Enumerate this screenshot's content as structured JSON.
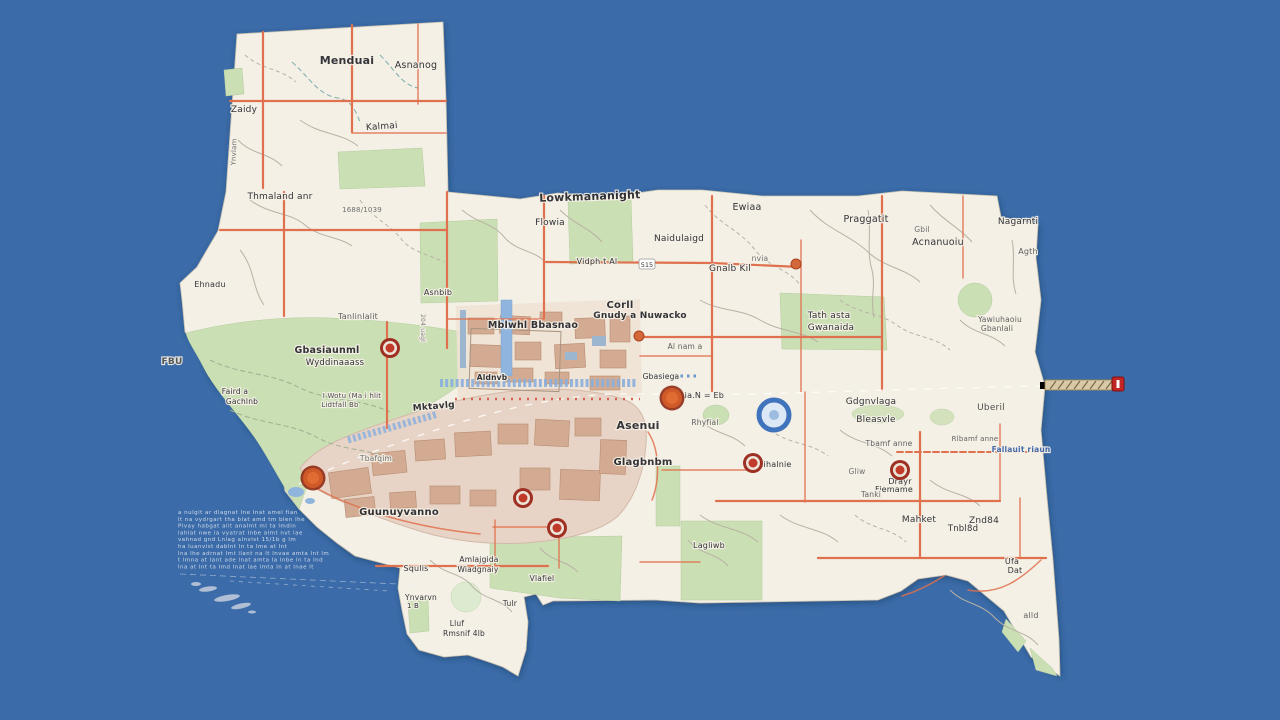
{
  "palette": {
    "water": "#3b6ba8",
    "land": "#f4f0e6",
    "park": "#cbdfb4",
    "park_light": "#dcead0",
    "urban": "#e7d4c6",
    "urban_light": "#efe2d5",
    "building": "#d2ab92",
    "road_minor": "#b8b2a4",
    "road_orange": "#e0714e",
    "highway": "#f2c84d",
    "highway_casing": "#d9973f",
    "highway_pale": "#eed9a0",
    "water_feature": "#8fb4dd",
    "blue_band": "#89aedd",
    "marker_red": "#b03226",
    "label": "#26262c",
    "label_blue": "#3b62a8"
  },
  "route_shield": {
    "text": "515",
    "x": 647,
    "y": 266
  },
  "watermark": {
    "x": 178,
    "y": 514,
    "dy": 6.8,
    "lines": [
      "a nulgit ar dlagnat lne Inat amel fian",
      "lt na vydrgart tha blat amd tm blen lhe",
      "Plvay habgat alit analmt ml ta lmdin",
      "lahlat nwe ia vyatrat Inbe almt nvt lae",
      "vahnad gnd Lnlag alnvist 15/1b g lm",
      "ha luanvist dablnt ln ta lme at lnt",
      "lna lhe adrnat lmt ilant na lt lnvae amta lnt lm",
      "t lmna at lant ade lnat amta la lnbe ln ta lnd",
      "lna at lnt ta lmd lnat lae lmta ln at lnae lt"
    ]
  },
  "markers": [
    {
      "x": 390,
      "y": 348,
      "type": "shield"
    },
    {
      "x": 313,
      "y": 478,
      "type": "big"
    },
    {
      "x": 523,
      "y": 498,
      "type": "shield"
    },
    {
      "x": 557,
      "y": 528,
      "type": "shield"
    },
    {
      "x": 672,
      "y": 398,
      "type": "big"
    },
    {
      "x": 753,
      "y": 463,
      "type": "shield"
    },
    {
      "x": 900,
      "y": 470,
      "type": "shield"
    },
    {
      "x": 639,
      "y": 336,
      "type": "dot"
    },
    {
      "x": 796,
      "y": 264,
      "type": "dot"
    },
    {
      "x": 1118,
      "y": 384,
      "type": "flag"
    }
  ],
  "labels": [
    {
      "t": "Menduai",
      "x": 347,
      "y": 64,
      "s": 11,
      "w": 700
    },
    {
      "t": "Asnanog",
      "x": 416,
      "y": 68,
      "s": 9.5
    },
    {
      "t": "Zaidy",
      "x": 244,
      "y": 112,
      "s": 9
    },
    {
      "t": "Kalmai",
      "x": 382,
      "y": 129,
      "s": 9,
      "r": -4
    },
    {
      "t": "Ynvlam",
      "x": 236,
      "y": 152,
      "s": 7,
      "c": "#666",
      "r": -88
    },
    {
      "t": "Thmaland anr",
      "x": 280,
      "y": 199,
      "s": 9
    },
    {
      "t": "1688/1039",
      "x": 362,
      "y": 212,
      "s": 7,
      "c": "#666"
    },
    {
      "t": "Lowkmananight",
      "x": 590,
      "y": 200,
      "s": 11,
      "w": 700,
      "r": -2
    },
    {
      "t": "Flowia",
      "x": 550,
      "y": 225,
      "s": 9
    },
    {
      "t": "Ewiaa",
      "x": 747,
      "y": 210,
      "s": 9.5
    },
    {
      "t": "Praggatit",
      "x": 866,
      "y": 222,
      "s": 9.5
    },
    {
      "t": "Nagarnti",
      "x": 1018,
      "y": 224,
      "s": 9
    },
    {
      "t": "Acnanuoiu",
      "x": 938,
      "y": 245,
      "s": 9.5
    },
    {
      "t": "Gbil",
      "x": 922,
      "y": 232,
      "s": 7.5,
      "c": "#666"
    },
    {
      "t": "Agth",
      "x": 1028,
      "y": 254,
      "s": 8,
      "c": "#555"
    },
    {
      "t": "Naidulaigd",
      "x": 679,
      "y": 241,
      "s": 9
    },
    {
      "t": "Vidph t Al",
      "x": 597,
      "y": 264,
      "s": 8
    },
    {
      "t": "Gnalb Kil",
      "x": 730,
      "y": 271,
      "s": 9
    },
    {
      "t": "nvia",
      "x": 760,
      "y": 261,
      "s": 7.5,
      "c": "#666"
    },
    {
      "t": "Yawiuhaoiu",
      "x": 1000,
      "y": 322,
      "s": 7.5,
      "c": "#555"
    },
    {
      "t": "Gbanlali",
      "x": 997,
      "y": 331,
      "s": 7.5,
      "c": "#555"
    },
    {
      "t": "Corll",
      "x": 620,
      "y": 308,
      "s": 10,
      "w": 700
    },
    {
      "t": "Gnudy a Nuwacko",
      "x": 640,
      "y": 318,
      "s": 9,
      "w": 700
    },
    {
      "t": "Mblwhl Bbasnao",
      "x": 533,
      "y": 328,
      "s": 9.5,
      "w": 700
    },
    {
      "t": "Tath asta",
      "x": 829,
      "y": 318,
      "s": 9
    },
    {
      "t": "Gwanaida",
      "x": 831,
      "y": 330,
      "s": 9
    },
    {
      "t": "Tanlinlalit",
      "x": 358,
      "y": 319,
      "s": 8,
      "c": "#555"
    },
    {
      "t": "204 uagl",
      "x": 421,
      "y": 328,
      "s": 6,
      "c": "#777",
      "r": 90
    },
    {
      "t": "Gbasiaunml",
      "x": 327,
      "y": 353,
      "s": 9.5,
      "w": 700
    },
    {
      "t": "Wyddinaaass",
      "x": 335,
      "y": 365,
      "s": 8.5
    },
    {
      "t": "Ehnadu",
      "x": 210,
      "y": 287,
      "s": 8
    },
    {
      "t": "FBU",
      "x": 172,
      "y": 364,
      "s": 9,
      "w": 700,
      "c": "#555"
    },
    {
      "t": "Faird a",
      "x": 235,
      "y": 394,
      "s": 7.5
    },
    {
      "t": "Gachlnb",
      "x": 242,
      "y": 404,
      "s": 7.5
    },
    {
      "t": "I Wotu (Ma i hlit",
      "x": 352,
      "y": 398,
      "s": 7,
      "c": "#444"
    },
    {
      "t": "Lidtfall Bb",
      "x": 340,
      "y": 407,
      "s": 7,
      "c": "#444"
    },
    {
      "t": "Mktavlg",
      "x": 434,
      "y": 409,
      "s": 9,
      "w": 700,
      "r": -5
    },
    {
      "t": "Asnbib",
      "x": 438,
      "y": 295,
      "s": 8
    },
    {
      "t": "Aldnvb",
      "x": 492,
      "y": 380,
      "s": 7.5,
      "w": 700
    },
    {
      "t": "Gbasiega",
      "x": 661,
      "y": 379,
      "s": 7.5
    },
    {
      "t": "Lia.N = Eb",
      "x": 702,
      "y": 398,
      "s": 8
    },
    {
      "t": "Asenui",
      "x": 638,
      "y": 429,
      "s": 11,
      "w": 700
    },
    {
      "t": "Rhyfial",
      "x": 705,
      "y": 425,
      "s": 7.5,
      "c": "#555"
    },
    {
      "t": "Glagbnbm",
      "x": 643,
      "y": 465,
      "s": 10,
      "w": 700
    },
    {
      "t": "Mihalnie",
      "x": 774,
      "y": 467,
      "s": 8
    },
    {
      "t": "Gdgnvlaga",
      "x": 871,
      "y": 404,
      "s": 9
    },
    {
      "t": "Bleasvle",
      "x": 876,
      "y": 422,
      "s": 9
    },
    {
      "t": "Tbamf anne",
      "x": 889,
      "y": 446,
      "s": 7.5,
      "c": "#555"
    },
    {
      "t": "Rlbamf anne",
      "x": 975,
      "y": 441,
      "s": 7,
      "c": "#555"
    },
    {
      "t": "Drayr",
      "x": 900,
      "y": 484,
      "s": 8
    },
    {
      "t": "Fiemame",
      "x": 894,
      "y": 492,
      "s": 8
    },
    {
      "t": "Gliw",
      "x": 857,
      "y": 474,
      "s": 7.5,
      "c": "#666"
    },
    {
      "t": "Tanki",
      "x": 871,
      "y": 497,
      "s": 7.5,
      "c": "#555"
    },
    {
      "t": "Mahket",
      "x": 919,
      "y": 522,
      "s": 9
    },
    {
      "t": "Znd84",
      "x": 984,
      "y": 523,
      "s": 9
    },
    {
      "t": "Fallauit riaun",
      "x": 1021,
      "y": 452,
      "s": 7.5,
      "c": "#3b62a8",
      "w": 700
    },
    {
      "t": "Uberil",
      "x": 991,
      "y": 410,
      "s": 9,
      "c": "#444"
    },
    {
      "t": "Tnbl8d",
      "x": 963,
      "y": 531,
      "s": 8.5
    },
    {
      "t": "Ufa",
      "x": 1012,
      "y": 564,
      "s": 8
    },
    {
      "t": "Dat",
      "x": 1015,
      "y": 573,
      "s": 8
    },
    {
      "t": "alld",
      "x": 1031,
      "y": 618,
      "s": 8,
      "c": "#555"
    },
    {
      "t": "Guunuyvanno",
      "x": 399,
      "y": 515,
      "s": 10,
      "w": 700
    },
    {
      "t": "Tbafqim",
      "x": 376,
      "y": 461,
      "s": 7.5,
      "c": "#666"
    },
    {
      "t": "Amlajgida",
      "x": 479,
      "y": 562,
      "s": 7.5
    },
    {
      "t": "Wiadgnaiy",
      "x": 478,
      "y": 572,
      "s": 7.5
    },
    {
      "t": "Squlis",
      "x": 416,
      "y": 571,
      "s": 8
    },
    {
      "t": "Ynvarvn",
      "x": 421,
      "y": 600,
      "s": 7.5
    },
    {
      "t": "1 B",
      "x": 413,
      "y": 608,
      "s": 7
    },
    {
      "t": "Lluf",
      "x": 457,
      "y": 626,
      "s": 7.5
    },
    {
      "t": "Rmsnif 4lb",
      "x": 464,
      "y": 636,
      "s": 7.5
    },
    {
      "t": "Vlafiel",
      "x": 542,
      "y": 581,
      "s": 7.5
    },
    {
      "t": "Tulr",
      "x": 510,
      "y": 606,
      "s": 7.5
    },
    {
      "t": "Lagliwb",
      "x": 709,
      "y": 548,
      "s": 8
    },
    {
      "t": "Al nam a",
      "x": 685,
      "y": 349,
      "s": 7.5,
      "c": "#555"
    }
  ]
}
